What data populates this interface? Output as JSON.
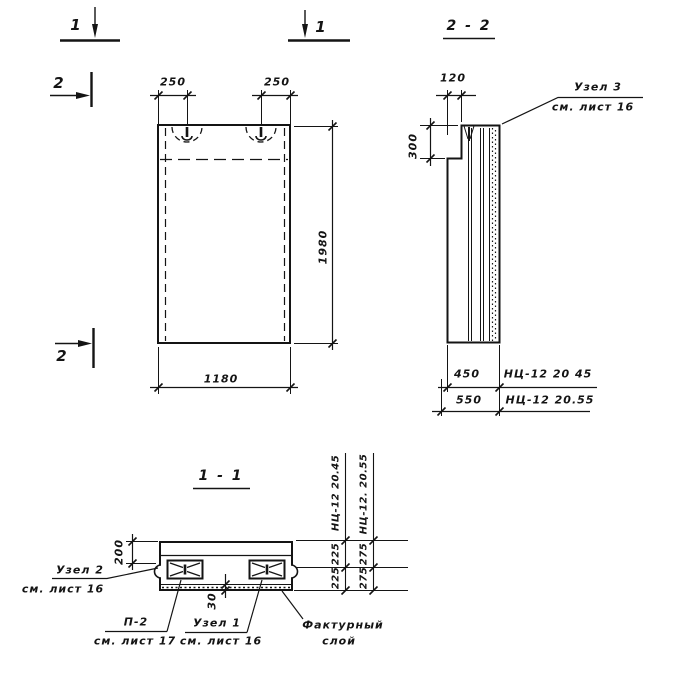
{
  "drawing": {
    "section_markers": {
      "m1_left": "1",
      "m1_right": "1",
      "m2_top": "2",
      "m2_bottom": "2"
    },
    "front_view": {
      "dim_loop_left": "250",
      "dim_loop_right": "250",
      "dim_height": "1980",
      "dim_width": "1180"
    },
    "section_2_2": {
      "title": "2 - 2",
      "dim_top_step": "120",
      "dim_side_step": "300",
      "callout_node3": {
        "line1": "Узел 3",
        "line2": "см. лист 16"
      },
      "rows": [
        {
          "dim": "450",
          "mark": "НЦ-12 20 45"
        },
        {
          "dim": "550",
          "mark": "НЦ-12 20.55"
        }
      ]
    },
    "section_1_1": {
      "title": "1 - 1",
      "dim_top_layer": "200",
      "dim_facing_layer": "30",
      "callout_node2": {
        "line1": "Узел 2",
        "line2": "см. лист 16"
      },
      "callout_p2": {
        "line1": "П-2",
        "line2": "см. лист 17"
      },
      "callout_node1": {
        "line1": "Узел 1",
        "line2": "см. лист 16"
      },
      "callout_facing": {
        "line1": "Фактурный",
        "line2": "слой"
      },
      "columns": [
        {
          "mark": "НЦ-12 20.45",
          "top": "225",
          "bottom": "225"
        },
        {
          "mark": "НЦ-12. 20.55",
          "top": "275",
          "bottom": "275"
        }
      ]
    },
    "line_color": "#141414"
  }
}
